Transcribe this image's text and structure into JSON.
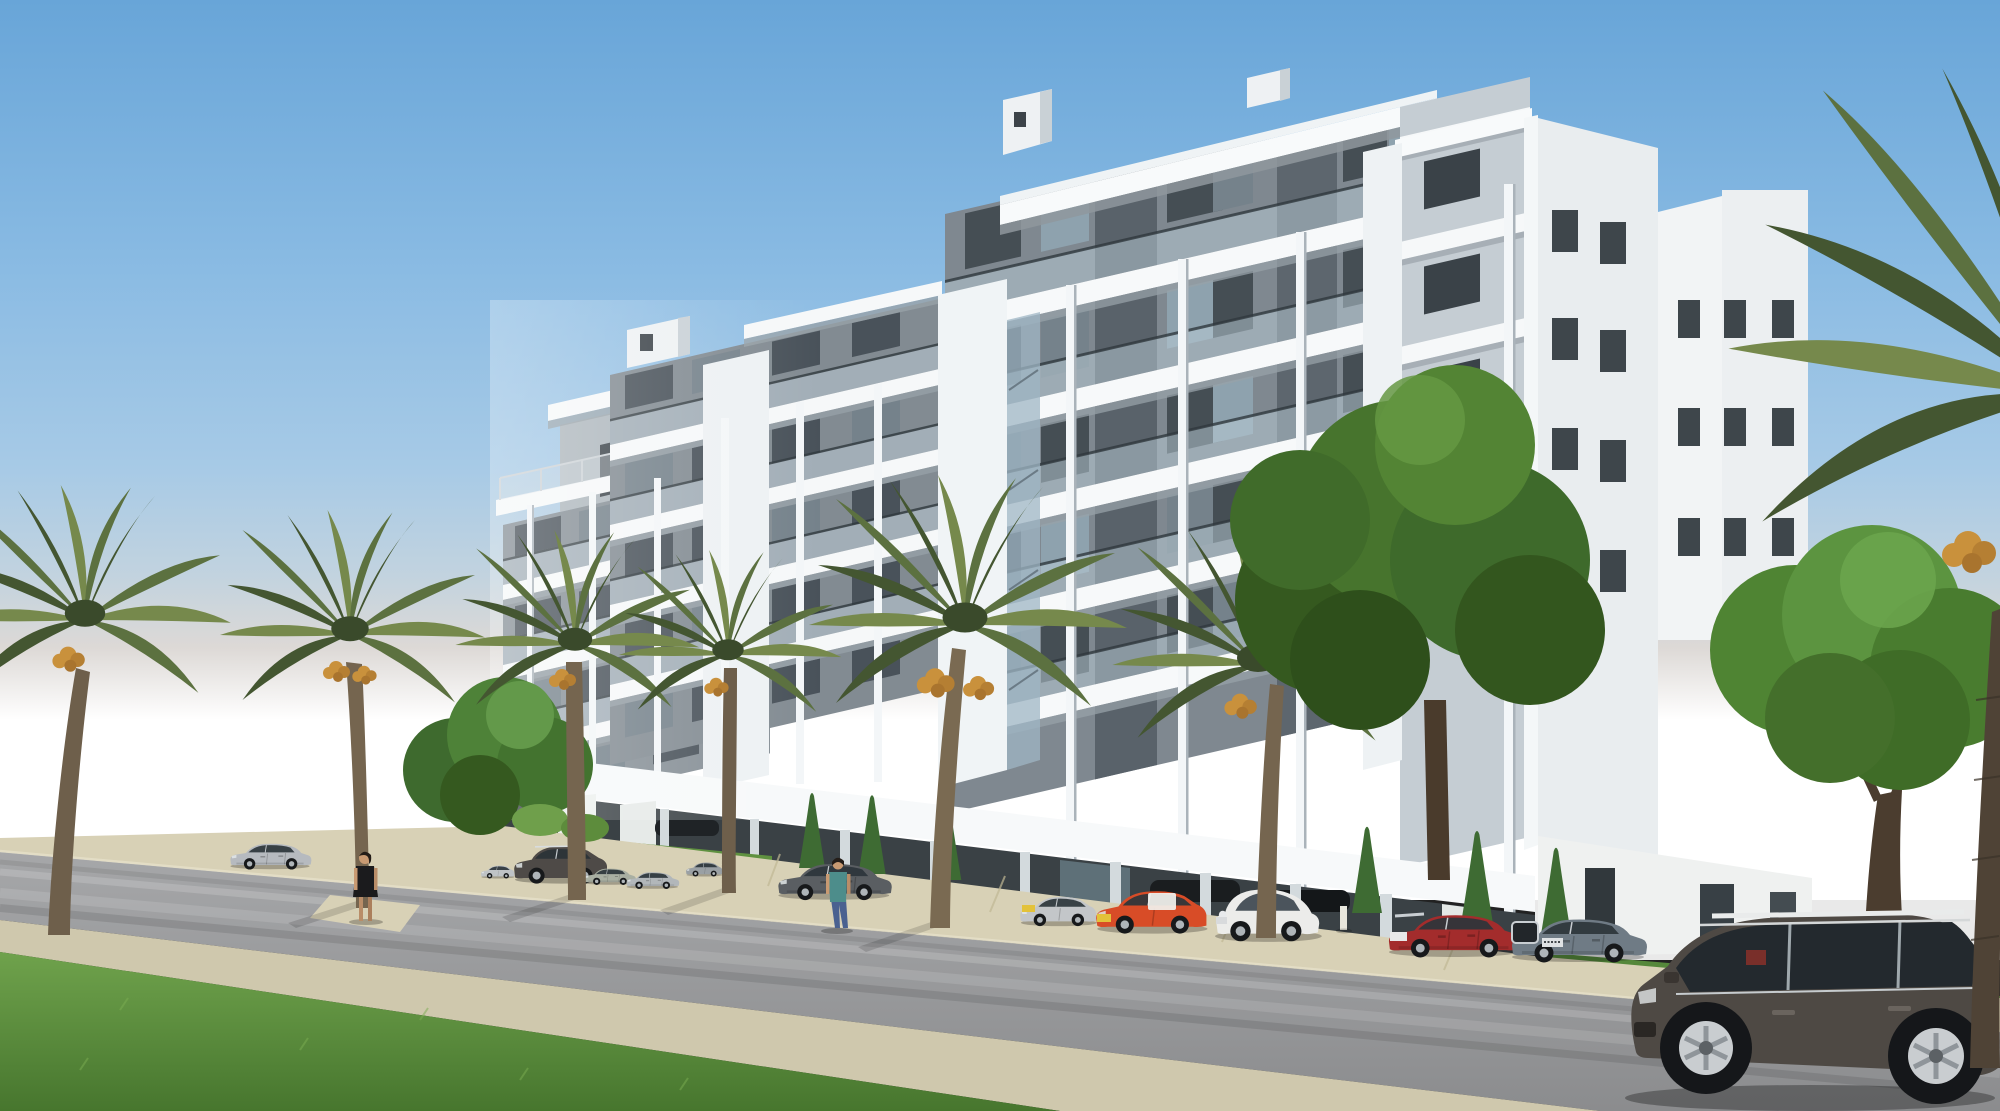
{
  "image": {
    "kind": "architectural-3d-render",
    "setting": "modern seaside apartment building, street view with palms and parked cars",
    "width_px": 2000,
    "height_px": 1111
  },
  "palette": {
    "sky_top": "#68a5d8",
    "sky_mid": "#a7cae6",
    "sky_horizon": "#f2efec",
    "haze_white": "#ffffff",
    "building_white": "#f6f8f9",
    "building_shade": "#e7ecef",
    "facade_gray": "#868f96",
    "facade_dark": "#59626a",
    "glass_rail": "#bccdd8",
    "window_dark": "#49525a",
    "slab_shadow": "#97a1a8",
    "ground_floor_dark": "#3a4145",
    "road": "#97989a",
    "sidewalk": "#d8d1b6",
    "grass_light": "#6fa24c",
    "grass_dark": "#47762e",
    "palm_dark": "#445631",
    "palm_mid": "#5c7140",
    "palm_light": "#76894c",
    "palm_trunk": "#75654f",
    "dates_orange": "#c9913c",
    "tree_green": "#47742d",
    "tree_dark": "#33561e",
    "cypress": "#3e6b33",
    "plate_yellow": "#e3c23a"
  },
  "building": {
    "style": "contemporary white stepped apartment block",
    "balcony_levels": 5,
    "blocks": 4,
    "features": [
      "cantilevered white roof slabs",
      "glass balcony balustrades",
      "round white columns",
      "gray recessed facades",
      "rooftop service boxes",
      "open pilotis parking at ground floor",
      "white end tower with small punched windows"
    ]
  },
  "vegetation": {
    "date_palms": 7,
    "palms_with_fruit": 5,
    "deciduous_trees": 3,
    "cypress_shrubs": 6
  },
  "vehicles": [
    {
      "id": "sedan-on-road-left",
      "type": "sedan",
      "color_name": "silver",
      "color": "#b6babf"
    },
    {
      "id": "hatchback-parked-1",
      "type": "hatchback",
      "color_name": "silver",
      "color": "#bfc3c6"
    },
    {
      "id": "suv-parked-dark",
      "type": "suv",
      "color_name": "dark gray",
      "color": "#4e4a47"
    },
    {
      "id": "sedan-parked-sage",
      "type": "sedan",
      "color_name": "sage silver",
      "color": "#a9afa2"
    },
    {
      "id": "sedan-parked-silver",
      "type": "sedan",
      "color_name": "silver",
      "color": "#b2b7ba"
    },
    {
      "id": "hatchback-parked-2",
      "type": "hatchback",
      "color_name": "gray",
      "color": "#9aa0a4"
    },
    {
      "id": "sedan-parked-graphite",
      "type": "sedan",
      "color_name": "graphite",
      "color": "#5a5e62"
    },
    {
      "id": "hatchback-astra",
      "type": "hatchback",
      "color_name": "silver",
      "color": "#c3c6c9"
    },
    {
      "id": "hatchback-clio",
      "type": "hatchback",
      "color_name": "orange red",
      "color": "#d84c27"
    },
    {
      "id": "citycar-fiat500",
      "type": "city car",
      "color_name": "white",
      "color": "#ececea"
    },
    {
      "id": "sedan-civic",
      "type": "sedan",
      "color_name": "dark red",
      "color": "#a32c2c"
    },
    {
      "id": "sedan-audi-a5",
      "type": "sedan",
      "color_name": "steel blue gray",
      "color": "#6f7b85"
    },
    {
      "id": "suv-audi-q7",
      "type": "suv",
      "color_name": "graphite brown",
      "color": "#4e4944"
    }
  ],
  "people": [
    {
      "id": "woman-standing",
      "description": "woman in black dress at kerb",
      "clothes": "#1b1b1d",
      "skin": "#c89a72"
    },
    {
      "id": "pedestrian-walking",
      "description": "pedestrian in teal top and jeans",
      "clothes": "#4d8d8b",
      "jeans": "#4a6190",
      "skin": "#c89a72"
    }
  ]
}
